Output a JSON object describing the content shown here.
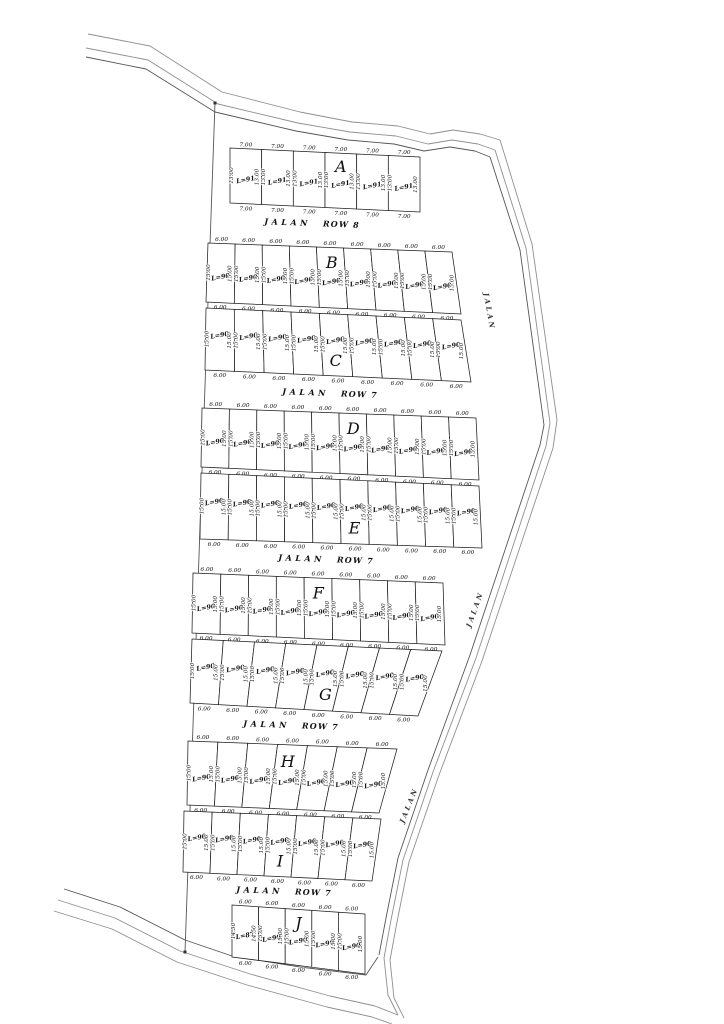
{
  "plan": {
    "blocks": [
      {
        "letter": "A",
        "count": 6,
        "letter_lot_index": 3,
        "letter_pos": "top",
        "skip_top_dims": false,
        "width_dim": "7.00",
        "depth_dim": "13.00",
        "area_label": "L=91",
        "quad": [
          [
            230,
            148
          ],
          [
            420,
            157
          ],
          [
            420,
            212
          ],
          [
            230,
            203
          ]
        ]
      },
      {
        "letter": "B",
        "count": 9,
        "letter_lot_index": 4,
        "letter_pos": "top",
        "skip_top_dims": false,
        "width_dim": "6.00",
        "depth_dim": "15.00",
        "area_label": "L=90",
        "quad": [
          [
            208,
            243
          ],
          [
            452,
            252
          ],
          [
            461,
            314
          ],
          [
            206,
            302
          ]
        ]
      },
      {
        "letter": "C",
        "count": 9,
        "letter_lot_index": 4,
        "letter_pos": "bottom",
        "skip_top_dims": true,
        "width_dim": "6.00",
        "depth_dim": "15.00",
        "area_label": "L=90",
        "quad": [
          [
            206,
            308
          ],
          [
            461,
            320
          ],
          [
            471,
            382
          ],
          [
            205,
            370
          ]
        ]
      },
      {
        "letter": "D",
        "count": 10,
        "letter_lot_index": 5,
        "letter_pos": "top",
        "skip_top_dims": false,
        "width_dim": "6.00",
        "depth_dim": "15.00",
        "area_label": "L=90",
        "quad": [
          [
            202,
            408
          ],
          [
            476,
            418
          ],
          [
            479,
            480
          ],
          [
            201,
            467
          ]
        ]
      },
      {
        "letter": "E",
        "count": 10,
        "letter_lot_index": 5,
        "letter_pos": "bottom",
        "skip_top_dims": true,
        "width_dim": "6.00",
        "depth_dim": "15.00",
        "area_label": "L=90",
        "quad": [
          [
            201,
            473
          ],
          [
            479,
            486
          ],
          [
            482,
            548
          ],
          [
            200,
            539
          ]
        ]
      },
      {
        "letter": "F",
        "count": 9,
        "letter_lot_index": 4,
        "letter_pos": "top",
        "skip_top_dims": false,
        "width_dim": "6.00",
        "depth_dim": "15.00",
        "area_label": "L=90",
        "quad": [
          [
            193,
            573
          ],
          [
            443,
            583
          ],
          [
            445,
            645
          ],
          [
            192,
            633
          ]
        ]
      },
      {
        "letter": "G",
        "count": 8,
        "letter_lot_index": 4,
        "letter_pos": "bottom",
        "skip_top_dims": true,
        "width_dim": "6.00",
        "depth_dim": "15.00",
        "area_label": "L=90",
        "quad": [
          [
            192,
            639
          ],
          [
            442,
            651
          ],
          [
            418,
            716
          ],
          [
            190,
            703
          ]
        ]
      },
      {
        "letter": "H",
        "count": 7,
        "letter_lot_index": 3,
        "letter_pos": "top",
        "skip_top_dims": false,
        "width_dim": "6.00",
        "depth_dim": "15.00",
        "area_label": "L=90",
        "quad": [
          [
            188,
            741
          ],
          [
            397,
            749
          ],
          [
            379,
            813
          ],
          [
            187,
            805
          ]
        ]
      },
      {
        "letter": "I",
        "count": 7,
        "letter_lot_index": 3,
        "letter_pos": "bottom",
        "skip_top_dims": true,
        "width_dim": "6.00",
        "depth_dim": "15.00",
        "area_label": "L=90",
        "quad": [
          [
            184,
            811
          ],
          [
            381,
            819
          ],
          [
            372,
            881
          ],
          [
            183,
            872
          ]
        ]
      },
      {
        "letter": "J",
        "count": 5,
        "letter_lot_index": 2,
        "letter_pos": "top",
        "skip_top_dims": false,
        "width_dim": "6.00",
        "depth_dim": "15.00",
        "area_label": "L=90",
        "area_labels": [
          "L=87",
          "L=90",
          "L=90",
          "L=90",
          "L=90"
        ],
        "depth_dims_per_lot": [
          "14.50",
          "15.00",
          "15.00",
          "15.00",
          "15.00"
        ],
        "quad": [
          [
            232,
            905
          ],
          [
            365,
            914
          ],
          [
            365,
            974
          ],
          [
            232,
            957
          ]
        ]
      }
    ],
    "street_labels": [
      {
        "name": "JALAN",
        "row": "ROW 8",
        "x": 312,
        "y": 226,
        "rotate": 2.2
      },
      {
        "name": "JALAN",
        "row": "ROW 7",
        "x": 330,
        "y": 396,
        "rotate": 2.2
      },
      {
        "name": "JALAN",
        "row": "ROW 7",
        "x": 326,
        "y": 562,
        "rotate": 2.2
      },
      {
        "name": "JALAN",
        "row": "ROW 7",
        "x": 291,
        "y": 728,
        "rotate": 2.2
      },
      {
        "name": "JALAN",
        "row": "ROW 7",
        "x": 284,
        "y": 894,
        "rotate": 2.2
      }
    ],
    "side_street_labels": [
      {
        "name": "JALAN",
        "x": 487,
        "y": 312,
        "rotate": 80
      },
      {
        "name": "JALAN",
        "x": 477,
        "y": 610,
        "rotate": -70
      },
      {
        "name": "JALAN",
        "x": 411,
        "y": 806,
        "rotate": -68
      }
    ],
    "boundary": [
      {
        "name": "north-road-outer",
        "cls": "road",
        "points": [
          [
            88,
            34
          ],
          [
            150,
            46
          ],
          [
            222,
            92
          ],
          [
            300,
            112
          ],
          [
            352,
            122
          ],
          [
            398,
            126
          ],
          [
            430,
            134
          ],
          [
            453,
            130
          ],
          [
            480,
            134
          ],
          [
            500,
            140
          ]
        ]
      },
      {
        "name": "north-road-mid",
        "cls": "road",
        "points": [
          [
            86,
            48
          ],
          [
            148,
            60
          ],
          [
            218,
            104
          ],
          [
            298,
            123
          ],
          [
            350,
            132
          ],
          [
            396,
            136
          ],
          [
            428,
            144
          ],
          [
            452,
            140
          ],
          [
            478,
            144
          ],
          [
            495,
            150
          ]
        ]
      },
      {
        "name": "north-road-inner",
        "cls": "roadin",
        "points": [
          [
            86,
            57
          ],
          [
            146,
            69
          ],
          [
            215,
            112
          ],
          [
            296,
            131
          ],
          [
            348,
            140
          ],
          [
            394,
            144
          ],
          [
            424,
            151
          ],
          [
            450,
            147
          ],
          [
            475,
            151
          ],
          [
            490,
            157
          ]
        ]
      },
      {
        "name": "east-road-outer",
        "cls": "road",
        "points": [
          [
            500,
            140
          ],
          [
            532,
            244
          ],
          [
            557,
            420
          ],
          [
            553,
            448
          ],
          [
            482,
            661
          ],
          [
            439,
            775
          ],
          [
            409,
            862
          ],
          [
            397,
            922
          ],
          [
            390,
            960
          ],
          [
            394,
            998
          ],
          [
            404,
            1018
          ]
        ]
      },
      {
        "name": "east-road-mid",
        "cls": "road",
        "points": [
          [
            495,
            150
          ],
          [
            526,
            248
          ],
          [
            550,
            423
          ],
          [
            546,
            446
          ],
          [
            476,
            658
          ],
          [
            433,
            772
          ],
          [
            403,
            860
          ],
          [
            391,
            920
          ],
          [
            384,
            958
          ],
          [
            388,
            995
          ],
          [
            398,
            1015
          ]
        ]
      },
      {
        "name": "east-road-inner",
        "cls": "roadin",
        "points": [
          [
            490,
            157
          ],
          [
            520,
            250
          ],
          [
            544,
            425
          ],
          [
            540,
            445
          ],
          [
            470,
            655
          ],
          [
            428,
            770
          ],
          [
            398,
            858
          ],
          [
            386,
            918
          ],
          [
            379,
            955
          ]
        ]
      },
      {
        "name": "south-road-inner",
        "cls": "roadin",
        "points": [
          [
            64,
            889
          ],
          [
            120,
            907
          ],
          [
            185,
            940
          ],
          [
            232,
            956
          ],
          [
            300,
            967
          ],
          [
            366,
            975
          ],
          [
            378,
            957
          ]
        ]
      },
      {
        "name": "south-road-mid",
        "cls": "road",
        "points": [
          [
            58,
            900
          ],
          [
            115,
            918
          ],
          [
            180,
            951
          ],
          [
            250,
            974
          ],
          [
            330,
            996
          ],
          [
            375,
            1006
          ],
          [
            398,
            1015
          ]
        ]
      },
      {
        "name": "south-road-outer",
        "cls": "road",
        "points": [
          [
            54,
            911
          ],
          [
            112,
            929
          ],
          [
            177,
            962
          ],
          [
            247,
            985
          ],
          [
            327,
            1007
          ],
          [
            372,
            1017
          ],
          [
            392,
            1024
          ]
        ]
      },
      {
        "name": "west-boundary",
        "cls": "roadin",
        "points": [
          [
            215,
            103
          ],
          [
            185,
            952
          ]
        ]
      }
    ],
    "boundary_markers": [
      [
        215,
        103
      ],
      [
        185,
        952
      ]
    ]
  }
}
